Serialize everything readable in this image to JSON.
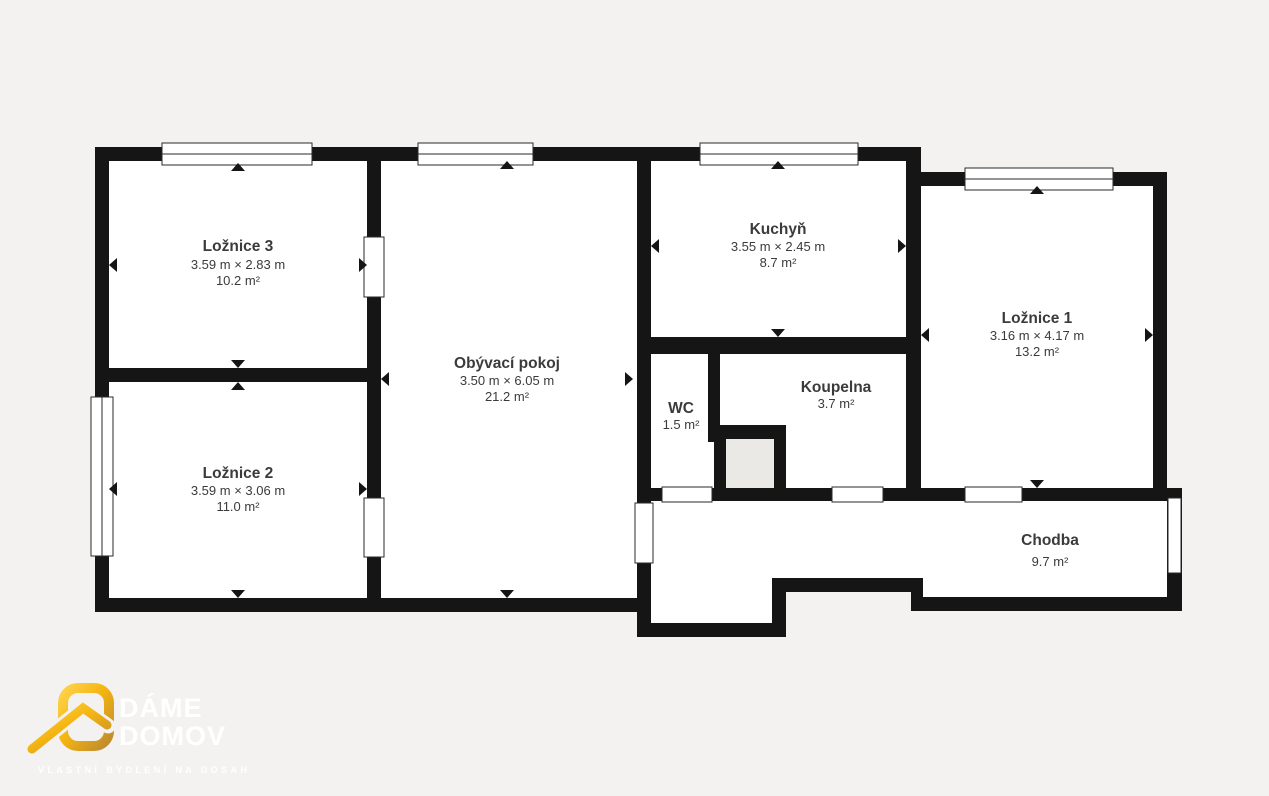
{
  "background_color": "#f3f2f0",
  "wall_color": "#151515",
  "floor_color": "#ffffff",
  "shaft_color": "#eae9e6",
  "plan": {
    "rooms": [
      {
        "name": "Ložnice 3",
        "dims": "3.59 m × 2.83 m",
        "area": "10.2 m²"
      },
      {
        "name": "Ložnice 2",
        "dims": "3.59 m × 3.06 m",
        "area": "11.0 m²"
      },
      {
        "name": "Obývací pokoj",
        "dims": "3.50 m × 6.05 m",
        "area": "21.2 m²"
      },
      {
        "name": "Kuchyň",
        "dims": "3.55 m × 2.45 m",
        "area": "8.7 m²"
      },
      {
        "name": "WC",
        "area": "1.5 m²"
      },
      {
        "name": "Koupelna",
        "area": "3.7 m²"
      },
      {
        "name": "Ložnice 1",
        "dims": "3.16 m × 4.17 m",
        "area": "13.2 m²"
      },
      {
        "name": "Chodba",
        "area": "9.7 m²"
      }
    ]
  },
  "branding": {
    "line1": "DÁME",
    "line2": "DOMOV",
    "tagline": "VLASTNÍ BYDLENÍ NA DOSAH",
    "brand_color": "#F5B511"
  }
}
